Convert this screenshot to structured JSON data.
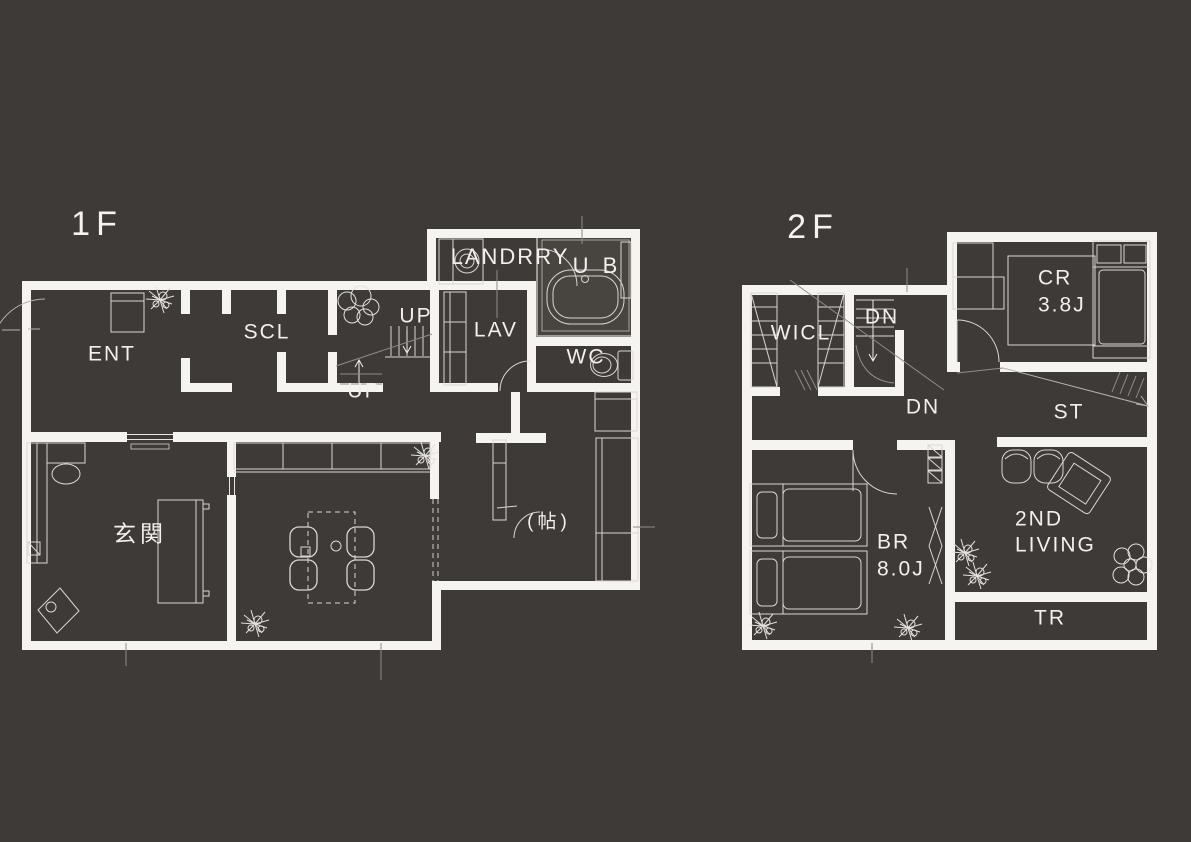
{
  "page": {
    "background_color": "#3e3a37",
    "wall_color": "#f6f4f1",
    "line_color": "#d9d6d2",
    "faint_line_color": "#8f8c88",
    "bath_fill_color": "#48443f"
  },
  "floor1": {
    "title": "1F",
    "labels": {
      "ent": "ENT",
      "scl": "SCL",
      "up_upper": "UP",
      "up_lower": "UP",
      "laundry": "LANDRRY",
      "bath": "U B",
      "lav": "LAV",
      "wc": "WC",
      "genkan": "玄関",
      "tatami": "(帖)"
    }
  },
  "floor2": {
    "title": "2F",
    "labels": {
      "wicl": "WICL",
      "dn_upper": "DN",
      "dn_lower": "DN",
      "cr": "CR",
      "cr_size": "3.8J",
      "st": "ST",
      "br": "BR",
      "br_size": "8.0J",
      "living_line1": "2ND",
      "living_line2": "LIVING",
      "tr": "TR"
    }
  }
}
